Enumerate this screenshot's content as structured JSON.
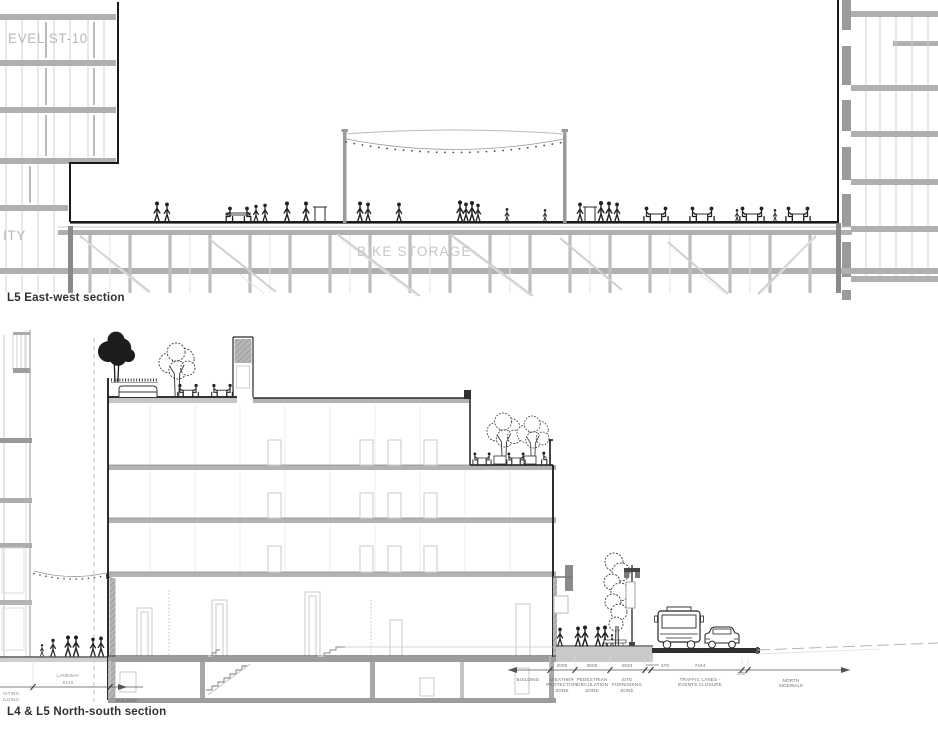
{
  "top": {
    "caption": "L5 East-west section",
    "labels": {
      "level": "EVEL ST-10",
      "amenity": "ITY",
      "bike_storage": "BIKE STORAGE"
    }
  },
  "bottom": {
    "caption": "L4 & L5 North-south section",
    "laneway": {
      "name": "LANEWAY",
      "dim": "6140"
    },
    "existing_building": "ISTING\nILDING",
    "building_slab": "BUILDING",
    "chain": {
      "building": "BUILDING",
      "zones": [
        {
          "dim": "2000",
          "label": "WEATHER\nPROTECTION\nZONE"
        },
        {
          "dim": "3000",
          "label": "PEDESTRIAN\nCIRCULATION\nZONE"
        },
        {
          "dim": "2933",
          "label": "SITE\nFURNISHING\nZONE"
        },
        {
          "dim": "270",
          "label": ""
        },
        {
          "dim": "7444",
          "label": "TRAFFIC LANES -\nEVENTS CLOSURE"
        },
        {
          "dim": "275",
          "label": ""
        },
        {
          "dim": "",
          "label": "NORTH\nSIDEWALK"
        }
      ]
    }
  },
  "colors": {
    "cut_line": "#1a1a1a",
    "slab_gray": "#b0b0b0",
    "light_line": "#cccccc",
    "label_gray": "#b8b8b8",
    "dim_text": "#707070",
    "caption_text": "#303030"
  }
}
